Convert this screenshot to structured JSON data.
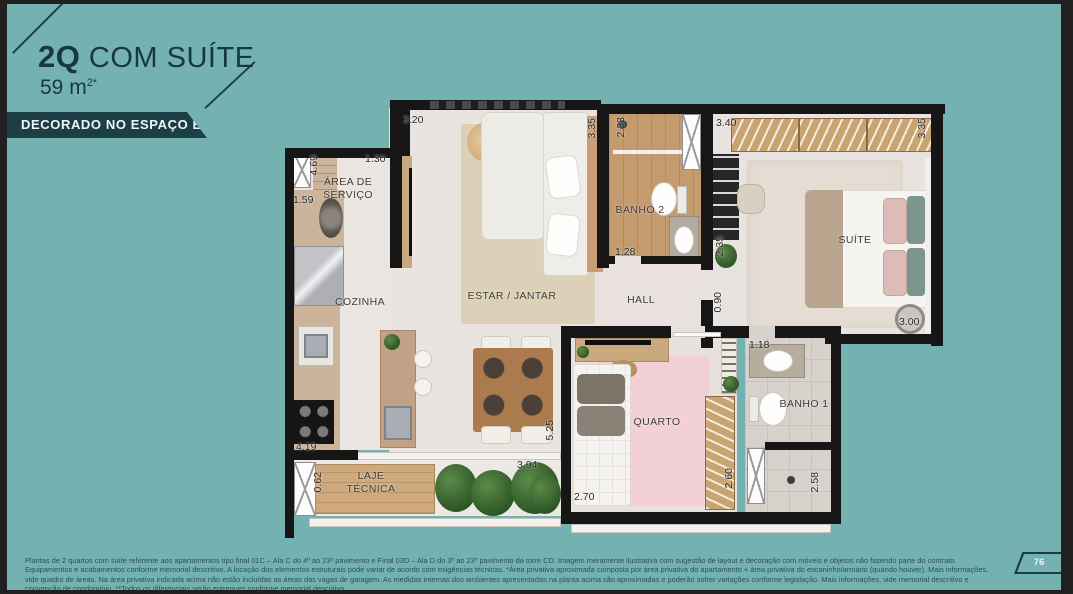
{
  "page": {
    "background": "#74b2b2",
    "frame_color": "#202020",
    "number": "76"
  },
  "header": {
    "title_bold": "2Q",
    "title_rest": " COM SUÍTE",
    "area_base": "59 m",
    "area_sup": "2*",
    "banner": "DECORADO NO ESPAÇO EBM"
  },
  "floorplan": {
    "rooms": [
      "ÁREA DE SERVIÇO",
      "COZINHA",
      "ESTAR / JANTAR",
      "BANHO 2",
      "HALL",
      "SUÍTE",
      "QUARTO",
      "BANHO 1",
      "LAJE TÉCNICA"
    ],
    "dimensions": [
      "3.20",
      "1.30",
      "4.69",
      "1.59",
      "3.35",
      "2.33",
      "1.28",
      "3.40",
      "3.35",
      "2.35",
      "3.00",
      "0.90",
      "1.18",
      "5.25",
      "3.94",
      "4.19",
      "0.62",
      "2.70",
      "2.60",
      "2.58"
    ]
  },
  "footer": {
    "disclaimer": "Plantas de 2 quartos com suíte referente aos apartamentos tipo final 01C – Ala C do 4º ao 23º pavimento e Final 03D – Ala D do 3º ao 23º pavimento da torre CD. Imagem meramente ilustrativa com sugestão de layout e decoração com móveis e objetos não fazendo parte do contrato. Equipamentos e acabamentos conforme memorial descritivo. A locação dos elementos estruturais pode variar de acordo com exigências técnicas. *Área privativa aproximada composta por área privativa do apartamento + área privativa do escaninho/armário (quando houver). Mais informações, vide quadro de áreas. Na área privativa indicada acima não estão incluídas as áreas das vagas de garagem. As medidas internas dos ambientes apresentadas na planta acima são aproximadas e poderão sofrer variações conforme legislação. Mais informações, vide memorial descritivo e convenção de condomínio. **Todos os diferenciais serão entregues conforme memorial descritivo."
  }
}
